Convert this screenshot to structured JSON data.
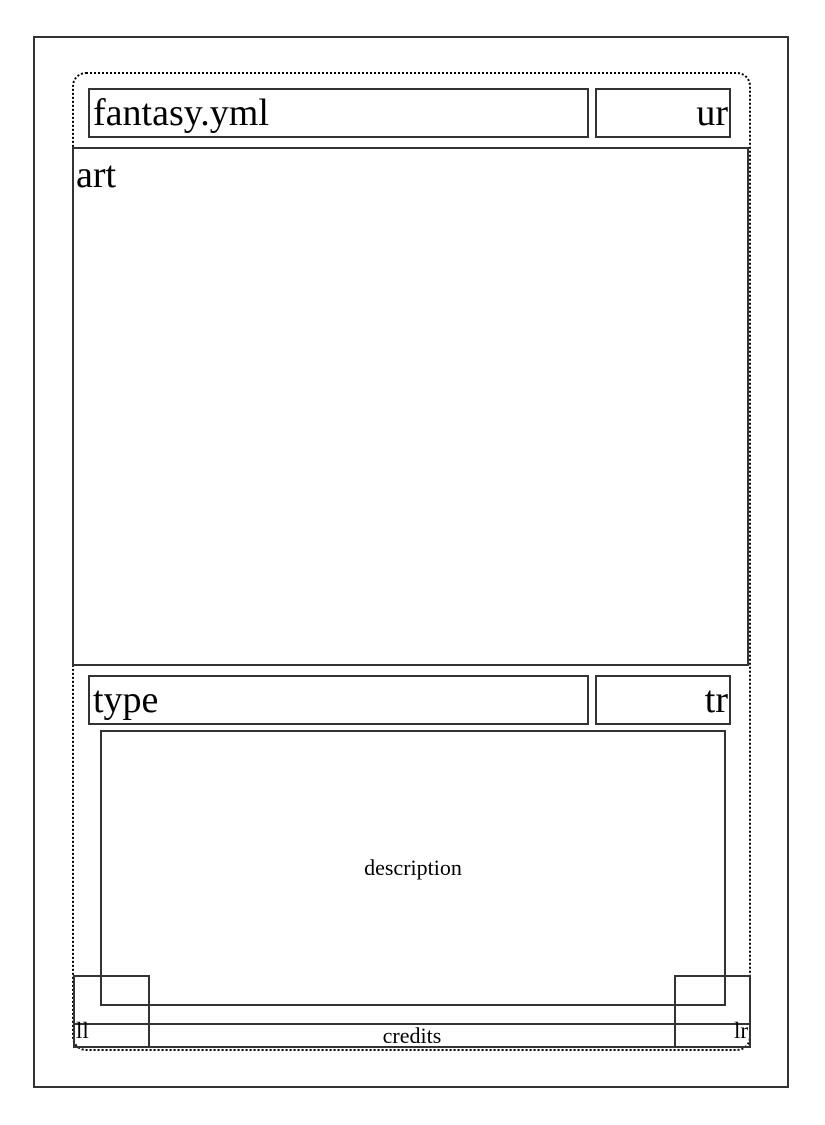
{
  "card_layout": {
    "title": "fantasy.yml",
    "upper_right": "ur",
    "art": "art",
    "type": "type",
    "type_right": "tr",
    "description": "description",
    "lower_left": "ll",
    "credits": "credits",
    "lower_right": "lr"
  },
  "colors": {
    "line": "#333333",
    "dotted_line": "#000000",
    "text": "#000000",
    "background": "#ffffff"
  }
}
